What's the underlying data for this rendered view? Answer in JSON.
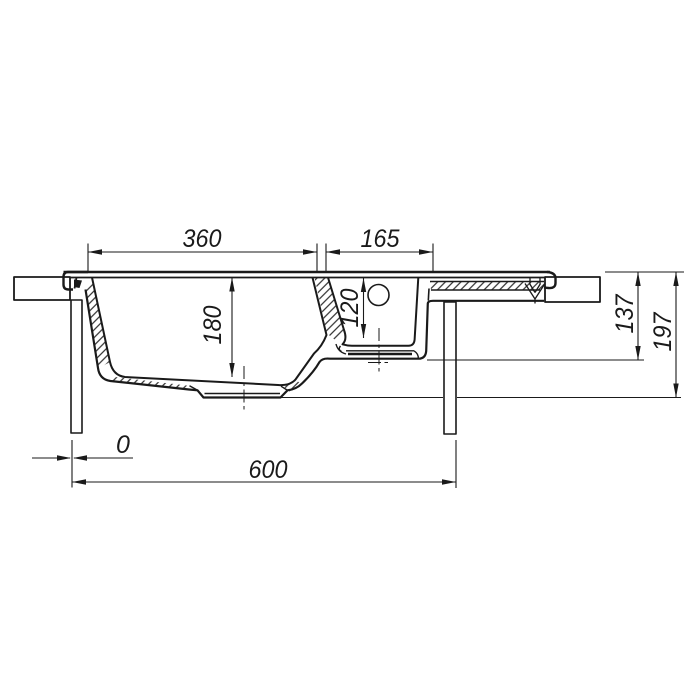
{
  "dimension_values": {
    "main_bowl_width": "360",
    "small_bowl_width": "165",
    "main_bowl_depth": "180",
    "small_bowl_depth": "120",
    "small_bowl_overall_depth": "137",
    "main_bowl_overall_depth": "197",
    "zero_offset": "0",
    "cabinet_width": "600"
  },
  "colors": {
    "line": "#1a1a1a",
    "bg": "#ffffff"
  }
}
